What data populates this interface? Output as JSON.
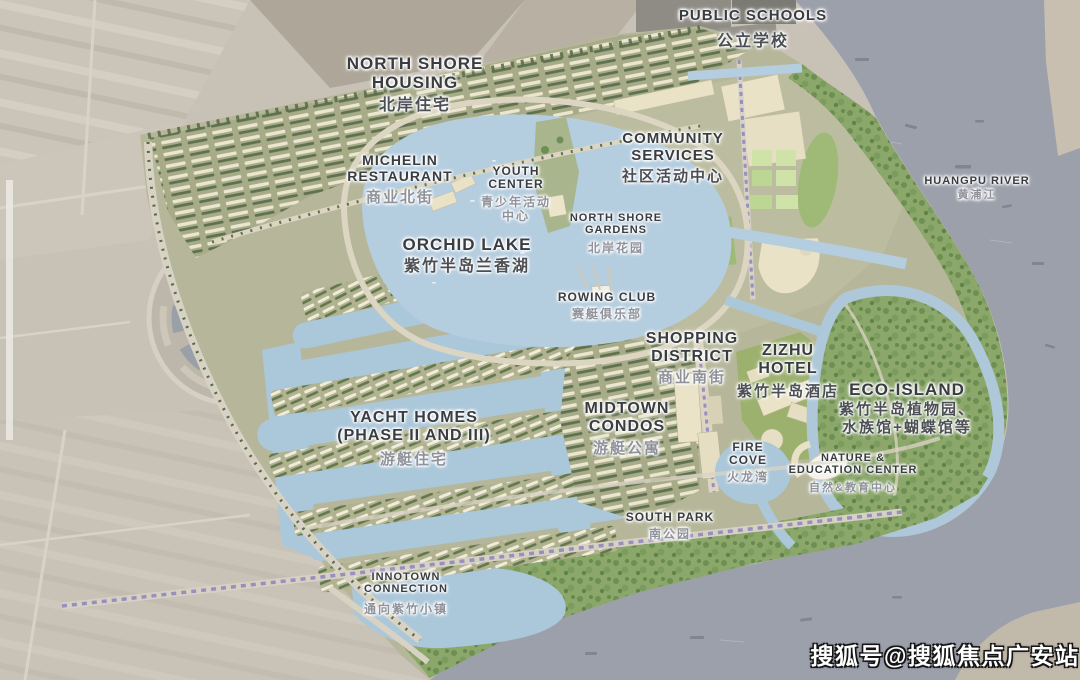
{
  "labels": {
    "public_schools": {
      "en": "PUBLIC SCHOOLS",
      "cn": "公立学校"
    },
    "north_shore_housing": {
      "en1": "NORTH SHORE",
      "en2": "HOUSING",
      "cn": "北岸住宅"
    },
    "michelin_restaurant": {
      "en1": "MICHELIN",
      "en2": "RESTAURANT",
      "cn": "商业北街"
    },
    "youth_center": {
      "en1": "YOUTH",
      "en2": "CENTER",
      "cn1": "青少年活动",
      "cn2": "中心"
    },
    "community_services": {
      "en1": "COMMUNITY",
      "en2": "SERVICES",
      "cn": "社区活动中心"
    },
    "north_shore_gardens": {
      "en1": "NORTH SHORE",
      "en2": "GARDENS",
      "cn": "北岸花园"
    },
    "huangpu_river": {
      "en": "HUANGPU RIVER",
      "cn": "黄浦江"
    },
    "orchid_lake": {
      "en": "ORCHID LAKE",
      "cn": "紫竹半岛兰香湖"
    },
    "rowing_club": {
      "en": "ROWING CLUB",
      "cn": "赛艇俱乐部"
    },
    "shopping_district": {
      "en1": "SHOPPING",
      "en2": "DISTRICT",
      "cn": "商业南街"
    },
    "zizhu_hotel": {
      "en1": "ZIZHU",
      "en2": "HOTEL",
      "cn": "紫竹半岛酒店"
    },
    "eco_island": {
      "en": "ECO-ISLAND",
      "cn1": "紫竹半岛植物园、",
      "cn2": "水族馆+蝴蝶馆等"
    },
    "yacht_homes": {
      "en1": "YACHT HOMES",
      "en2": "(PHASE II AND III)",
      "cn": "游艇住宅"
    },
    "midtown_condos": {
      "en1": "MIDTOWN",
      "en2": "CONDOS",
      "cn": "游艇公寓"
    },
    "fire_cove": {
      "en1": "FIRE",
      "en2": "COVE",
      "cn": "火龙湾"
    },
    "nature_education_center": {
      "en1": "NATURE &",
      "en2": "EDUCATION CENTER",
      "cn": "自然&教育中心"
    },
    "south_park": {
      "en": "SOUTH PARK",
      "cn": "南公园"
    },
    "innotown_connection": {
      "en1": "INNOTOWN",
      "en2": "CONNECTION",
      "cn": "通向紫竹小镇"
    }
  },
  "watermark": {
    "text": "搜狐号@搜狐焦点广安站"
  },
  "legend_colors": {
    "lake_water": "#b4cddf",
    "river_water": "#9ca0ab",
    "parkland_green": "#8ca76a",
    "development_ground": "#b6b79a",
    "street_trees_purple": "#968fc0",
    "label_dark": "#393c40",
    "label_gray": "#8f929a"
  }
}
